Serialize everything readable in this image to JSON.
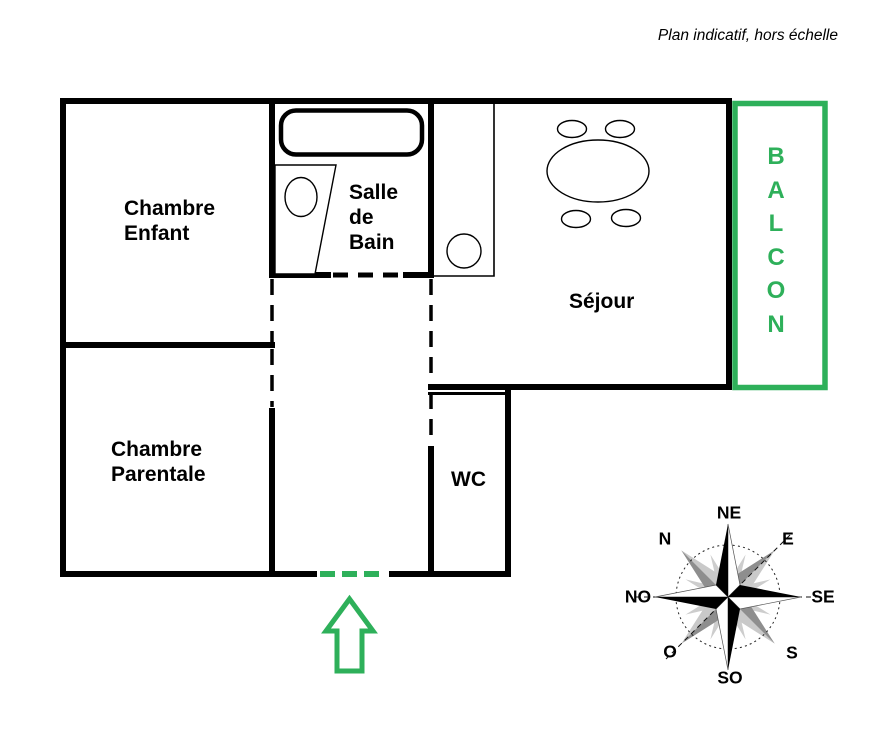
{
  "title_note": "Plan indicatif, hors échelle",
  "colors": {
    "wall": "#000000",
    "accent_green": "#2EB05A",
    "compass_gray": "#c9c9c9",
    "compass_dark_gray": "#8e8e8e",
    "compass_light_gray": "#cdcdcd"
  },
  "rooms": {
    "chambre_enfant": "Chambre\nEnfant",
    "chambre_parentale": "Chambre\nParentale",
    "salle_de_bain": "Salle\nde\nBain",
    "sejour": "Séjour",
    "wc": "WC"
  },
  "balcony": {
    "label": "BALCON",
    "letters": [
      "B",
      "A",
      "L",
      "C",
      "O",
      "N"
    ]
  },
  "compass": {
    "ne": "NE",
    "n": "N",
    "e": "E",
    "no": "NO",
    "se": "SE",
    "o": "O",
    "s": "S",
    "so": "SO"
  }
}
